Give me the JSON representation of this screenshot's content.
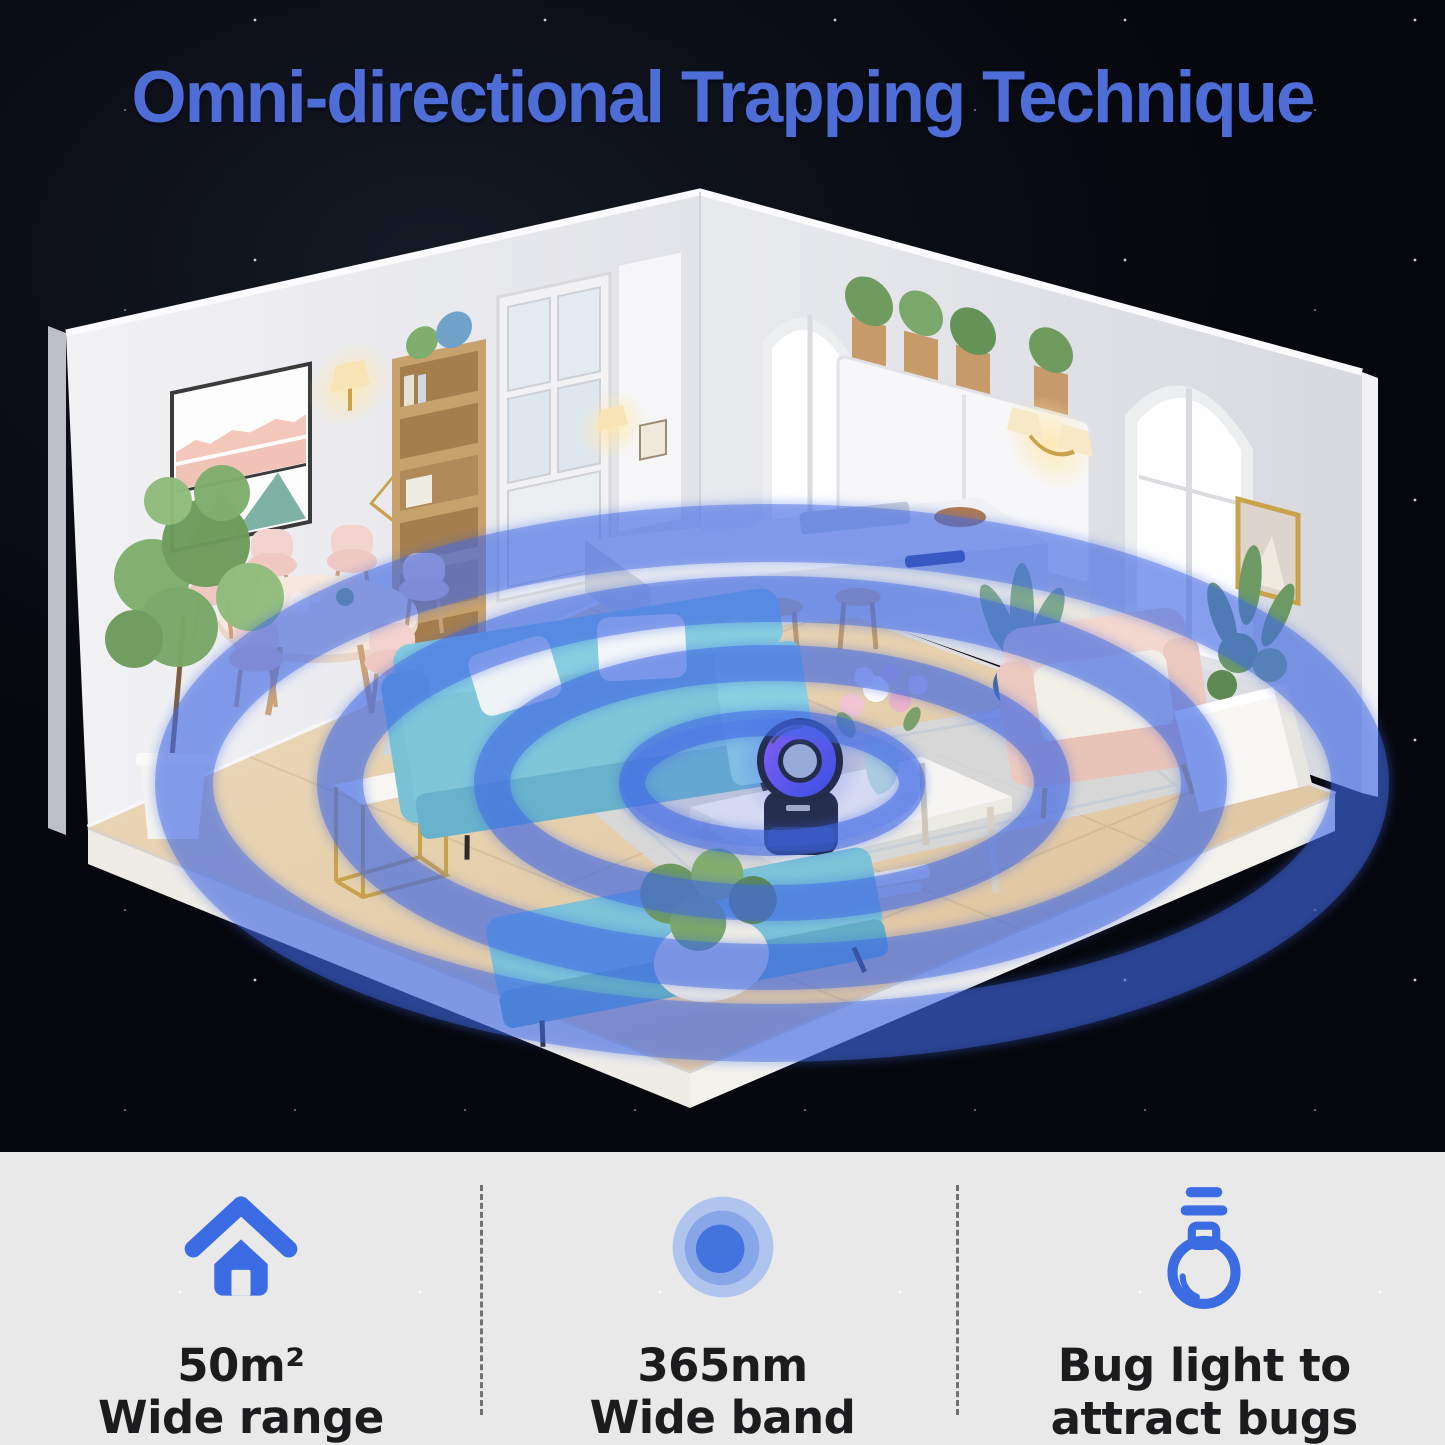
{
  "title": {
    "text": "Omni-directional Trapping Technique"
  },
  "features": [
    {
      "icon": "house-icon",
      "line1": "50m²",
      "line2": "Wide range"
    },
    {
      "icon": "concentric-circles-icon",
      "line1": "365nm",
      "line2": "Wide band"
    },
    {
      "icon": "light-bulb-icon",
      "line1": "Bug light to",
      "line2": "attract bugs"
    }
  ],
  "scene": {
    "device": "bug zapper lamp",
    "wave_rings": 4
  },
  "colors": {
    "title_blue": "#4e6dd6",
    "icon_blue": "#3c6ce3",
    "wave_blue": "#3f68e4",
    "panel_gray": "#e9e9ea",
    "text_dark": "#1c1c1e",
    "sky_dark": "#0b0d15"
  }
}
